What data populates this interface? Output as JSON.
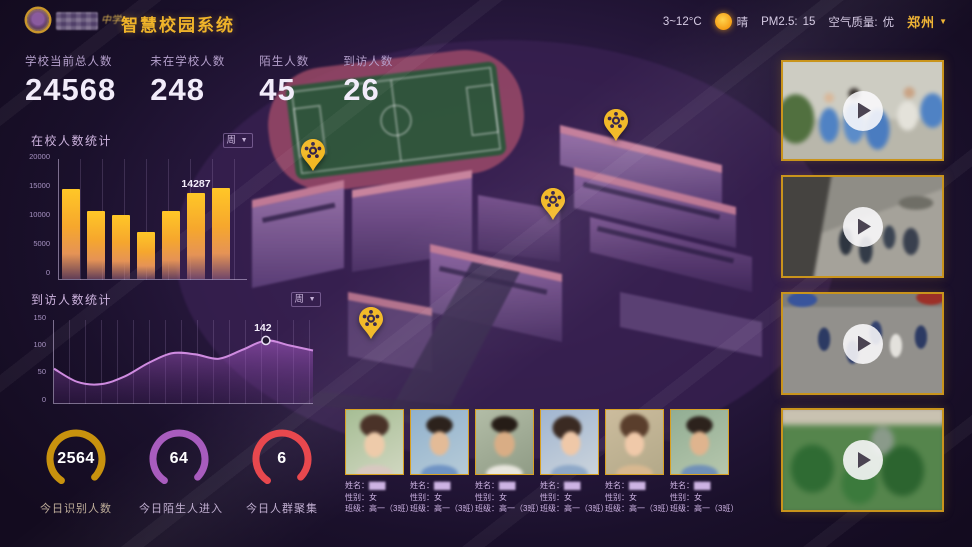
{
  "header": {
    "logo_suffix": "中学",
    "title": "智慧校园系统",
    "temp": "3~12°C",
    "condition": "晴",
    "pm_label": "PM2.5:",
    "pm_value": "15",
    "aqi_label": "空气质量:",
    "aqi_value": "优",
    "city": "郑州",
    "caret": "▼"
  },
  "stats": [
    {
      "label": "学校当前总人数",
      "value": "24568"
    },
    {
      "label": "未在学校人数",
      "value": "248"
    },
    {
      "label": "陌生人数",
      "value": "45"
    },
    {
      "label": "到访人数",
      "value": "26"
    }
  ],
  "chart_data": [
    {
      "type": "bar",
      "title": "在校人数统计",
      "filter": "周",
      "ylim": [
        0,
        20000
      ],
      "yticks": [
        "20000",
        "15000",
        "10000",
        "5000",
        "0"
      ],
      "values": [
        15000,
        11350,
        10600,
        7800,
        11350,
        14287,
        15200
      ],
      "highlight_index": 5,
      "highlight_label": "14287",
      "grid": "vertical",
      "legend": "none"
    },
    {
      "type": "area",
      "title": "到访人数统计",
      "filter": "周",
      "ylim": [
        0,
        150
      ],
      "yticks": [
        "150",
        "100",
        "50",
        "0"
      ],
      "values": [
        62,
        38,
        34,
        48,
        72,
        90,
        88,
        80,
        96,
        113,
        104,
        95
      ],
      "marker_index": 9,
      "marker_label": "142",
      "grid": "vertical",
      "legend": "none"
    }
  ],
  "gauges": [
    {
      "value": "2564",
      "label": "今日识别人数",
      "color": "#c8920e"
    },
    {
      "value": "64",
      "label": "今日陌生人进入",
      "color": "#a85cbe"
    },
    {
      "value": "6",
      "label": "今日人群聚集",
      "color": "#e8484e"
    }
  ],
  "faces": [
    {
      "name_label": "姓名：",
      "name": "▇▇▇",
      "gender_label": "性别：",
      "gender": "女",
      "class_label": "班级：",
      "class_value": "高一（3班）"
    },
    {
      "name_label": "姓名：",
      "name": "▇▇▇",
      "gender_label": "性别：",
      "gender": "女",
      "class_label": "班级：",
      "class_value": "高一（3班）"
    },
    {
      "name_label": "姓名：",
      "name": "▇▇▇",
      "gender_label": "性别：",
      "gender": "女",
      "class_label": "班级：",
      "class_value": "高一（3班）"
    },
    {
      "name_label": "姓名：",
      "name": "▇▇▇",
      "gender_label": "性别：",
      "gender": "女",
      "class_label": "班级：",
      "class_value": "高一（3班）"
    },
    {
      "name_label": "姓名：",
      "name": "▇▇▇",
      "gender_label": "性别：",
      "gender": "女",
      "class_label": "班级：",
      "class_value": "高一（3班）"
    },
    {
      "name_label": "姓名：",
      "name": "▇▇▇",
      "gender_label": "性别：",
      "gender": "女",
      "class_label": "班级：",
      "class_value": "高一（3班）"
    }
  ],
  "videos": [
    {
      "id": "camera-feed-1"
    },
    {
      "id": "camera-feed-2"
    },
    {
      "id": "camera-feed-3"
    },
    {
      "id": "camera-feed-4"
    }
  ],
  "map": {
    "pins": [
      {
        "x": 313,
        "y": 172
      },
      {
        "x": 616,
        "y": 142
      },
      {
        "x": 553,
        "y": 221
      },
      {
        "x": 371,
        "y": 340
      }
    ]
  },
  "icons": {
    "sun": "sun-circle",
    "play": "play-triangle",
    "pin": "gold-location-pin",
    "caret": "▼"
  }
}
